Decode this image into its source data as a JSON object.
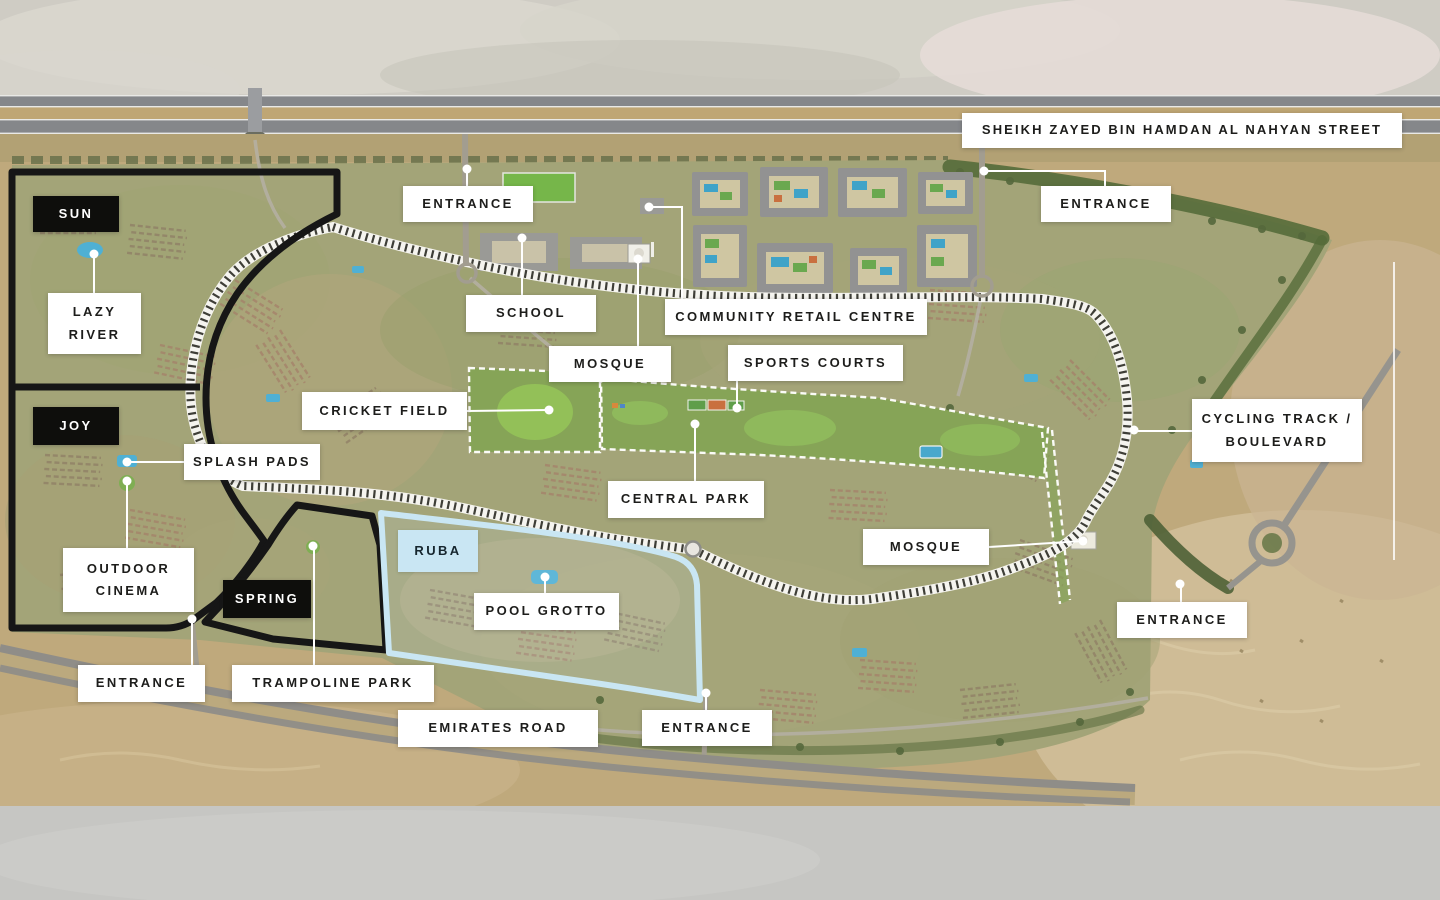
{
  "map": {
    "street_label": "SHEIKH ZAYED BIN HAMDAN AL NAHYAN STREET",
    "entrance_label": "ENTRANCE",
    "entrance_count": 6,
    "districts": {
      "sun": "SUN",
      "joy": "JOY",
      "spring": "SPRING",
      "ruba": "RUBA"
    },
    "amenities": {
      "lazy_river": "LAZY RIVER",
      "school": "SCHOOL",
      "community_retail_centre": "COMMUNITY RETAIL CENTRE",
      "mosque": "MOSQUE",
      "sports_courts": "SPORTS COURTS",
      "cricket_field": "CRICKET FIELD",
      "splash_pads": "SPLASH PADS",
      "central_park": "CENTRAL PARK",
      "cycling_track_boulevard": "CYCLING TRACK / BOULEVARD",
      "outdoor_cinema": "OUTDOOR CINEMA",
      "pool_grotto": "POOL GROTTO",
      "trampoline_park": "TRAMPOLINE PARK"
    },
    "roads": {
      "emirates_road": "EMIRATES ROAD"
    },
    "colors": {
      "label_bg": "#ffffff",
      "district_label_bg": "#0e0e0c",
      "ruba_highlight": "#c9e6f3",
      "boundary_black": "#161616",
      "park_green": "#86a457",
      "desert_sand": "#bfa97c",
      "pool_blue": "#4fb0d4"
    }
  }
}
